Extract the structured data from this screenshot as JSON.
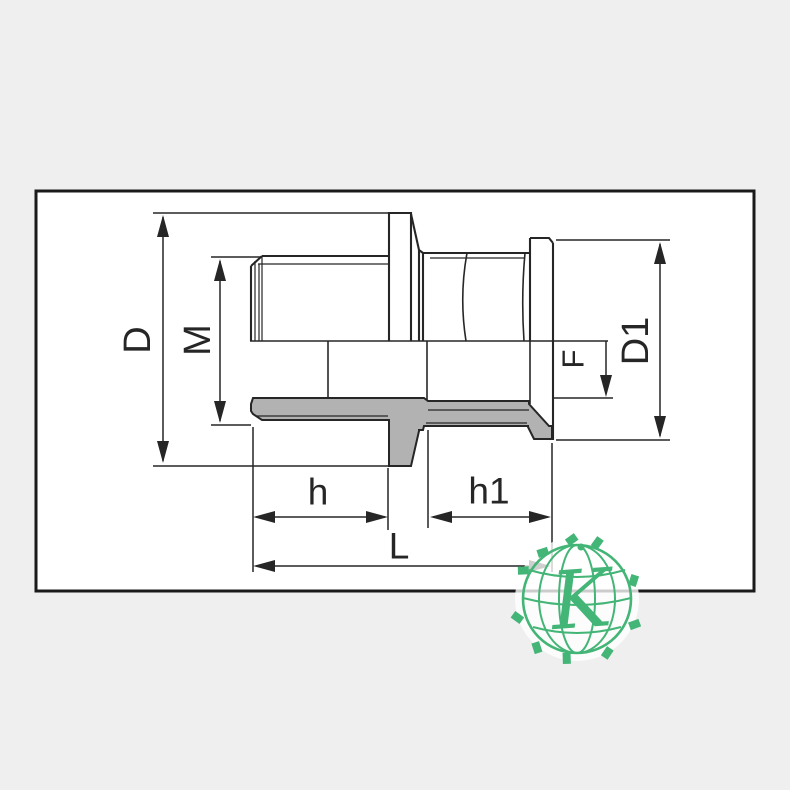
{
  "colors": {
    "background": "#efefef",
    "paper": "#ffffff",
    "line": "#262626",
    "section_fill": "#b2b2b2",
    "logo_green": "#43b576"
  },
  "dimension_labels": {
    "outer_diameter": "D",
    "thread_diameter": "M",
    "flange_diameter": "D1",
    "socket_depth": "F",
    "male_thread_length": "h",
    "socket_length": "h1",
    "overall_length": "L"
  },
  "logo": {
    "monogram": "K"
  }
}
